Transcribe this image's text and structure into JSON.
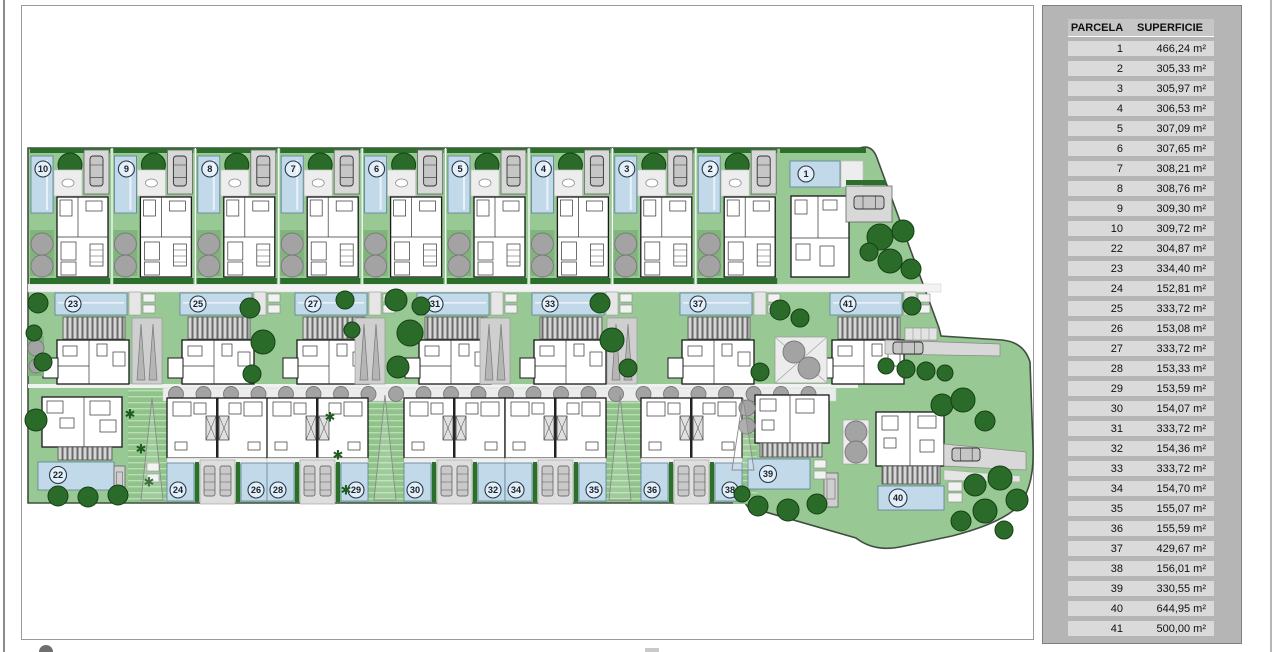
{
  "table": {
    "col_headers": [
      "PARCELA",
      "SUPERFICIE"
    ],
    "rows": [
      [
        "1",
        "466,24 m²"
      ],
      [
        "2",
        "305,33 m²"
      ],
      [
        "3",
        "305,97 m²"
      ],
      [
        "4",
        "306,53 m²"
      ],
      [
        "5",
        "307,09 m²"
      ],
      [
        "6",
        "307,65 m²"
      ],
      [
        "7",
        "308,21 m²"
      ],
      [
        "8",
        "308,76 m²"
      ],
      [
        "9",
        "309,30 m²"
      ],
      [
        "10",
        "309,72 m²"
      ],
      [
        "22",
        "304,87 m²"
      ],
      [
        "23",
        "334,40 m²"
      ],
      [
        "24",
        "152,81 m²"
      ],
      [
        "25",
        "333,72 m²"
      ],
      [
        "26",
        "153,08 m²"
      ],
      [
        "27",
        "333,72 m²"
      ],
      [
        "28",
        "153,33 m²"
      ],
      [
        "29",
        "153,59 m²"
      ],
      [
        "30",
        "154,07 m²"
      ],
      [
        "31",
        "333,72 m²"
      ],
      [
        "32",
        "154,36 m²"
      ],
      [
        "33",
        "333,72 m²"
      ],
      [
        "34",
        "154,70 m²"
      ],
      [
        "35",
        "155,07 m²"
      ],
      [
        "36",
        "155,59 m²"
      ],
      [
        "37",
        "429,67 m²"
      ],
      [
        "38",
        "156,01 m²"
      ],
      [
        "39",
        "330,55 m²"
      ],
      [
        "40",
        "644,95 m²"
      ],
      [
        "41",
        "500,00 m²"
      ]
    ]
  },
  "plan": {
    "top_villas": [
      "10",
      "9",
      "8",
      "7",
      "6",
      "5",
      "4",
      "3",
      "2",
      "1"
    ],
    "middle_villas": [
      "23",
      "25",
      "27",
      "31",
      "33",
      "37",
      "41"
    ],
    "corner_villa": "22",
    "duplex_pairs": [
      [
        "24",
        "26"
      ],
      [
        "28",
        "29"
      ],
      [
        "30",
        "32"
      ],
      [
        "34",
        "35"
      ],
      [
        "36",
        "38"
      ]
    ],
    "south_villas": [
      "39",
      "40"
    ]
  },
  "colors": {
    "site_green": "#98c893",
    "pool_blue": "#c2d9ea",
    "tree_green": "#2a6b2a",
    "hedge_green": "#2c6e2c",
    "gray_tree": "#a3a3a3",
    "paving_gray": "#d8d8d8",
    "panel_gray": "#b5b5b5",
    "row_gray": "#dadada",
    "header_gray": "#c6c6c6"
  }
}
